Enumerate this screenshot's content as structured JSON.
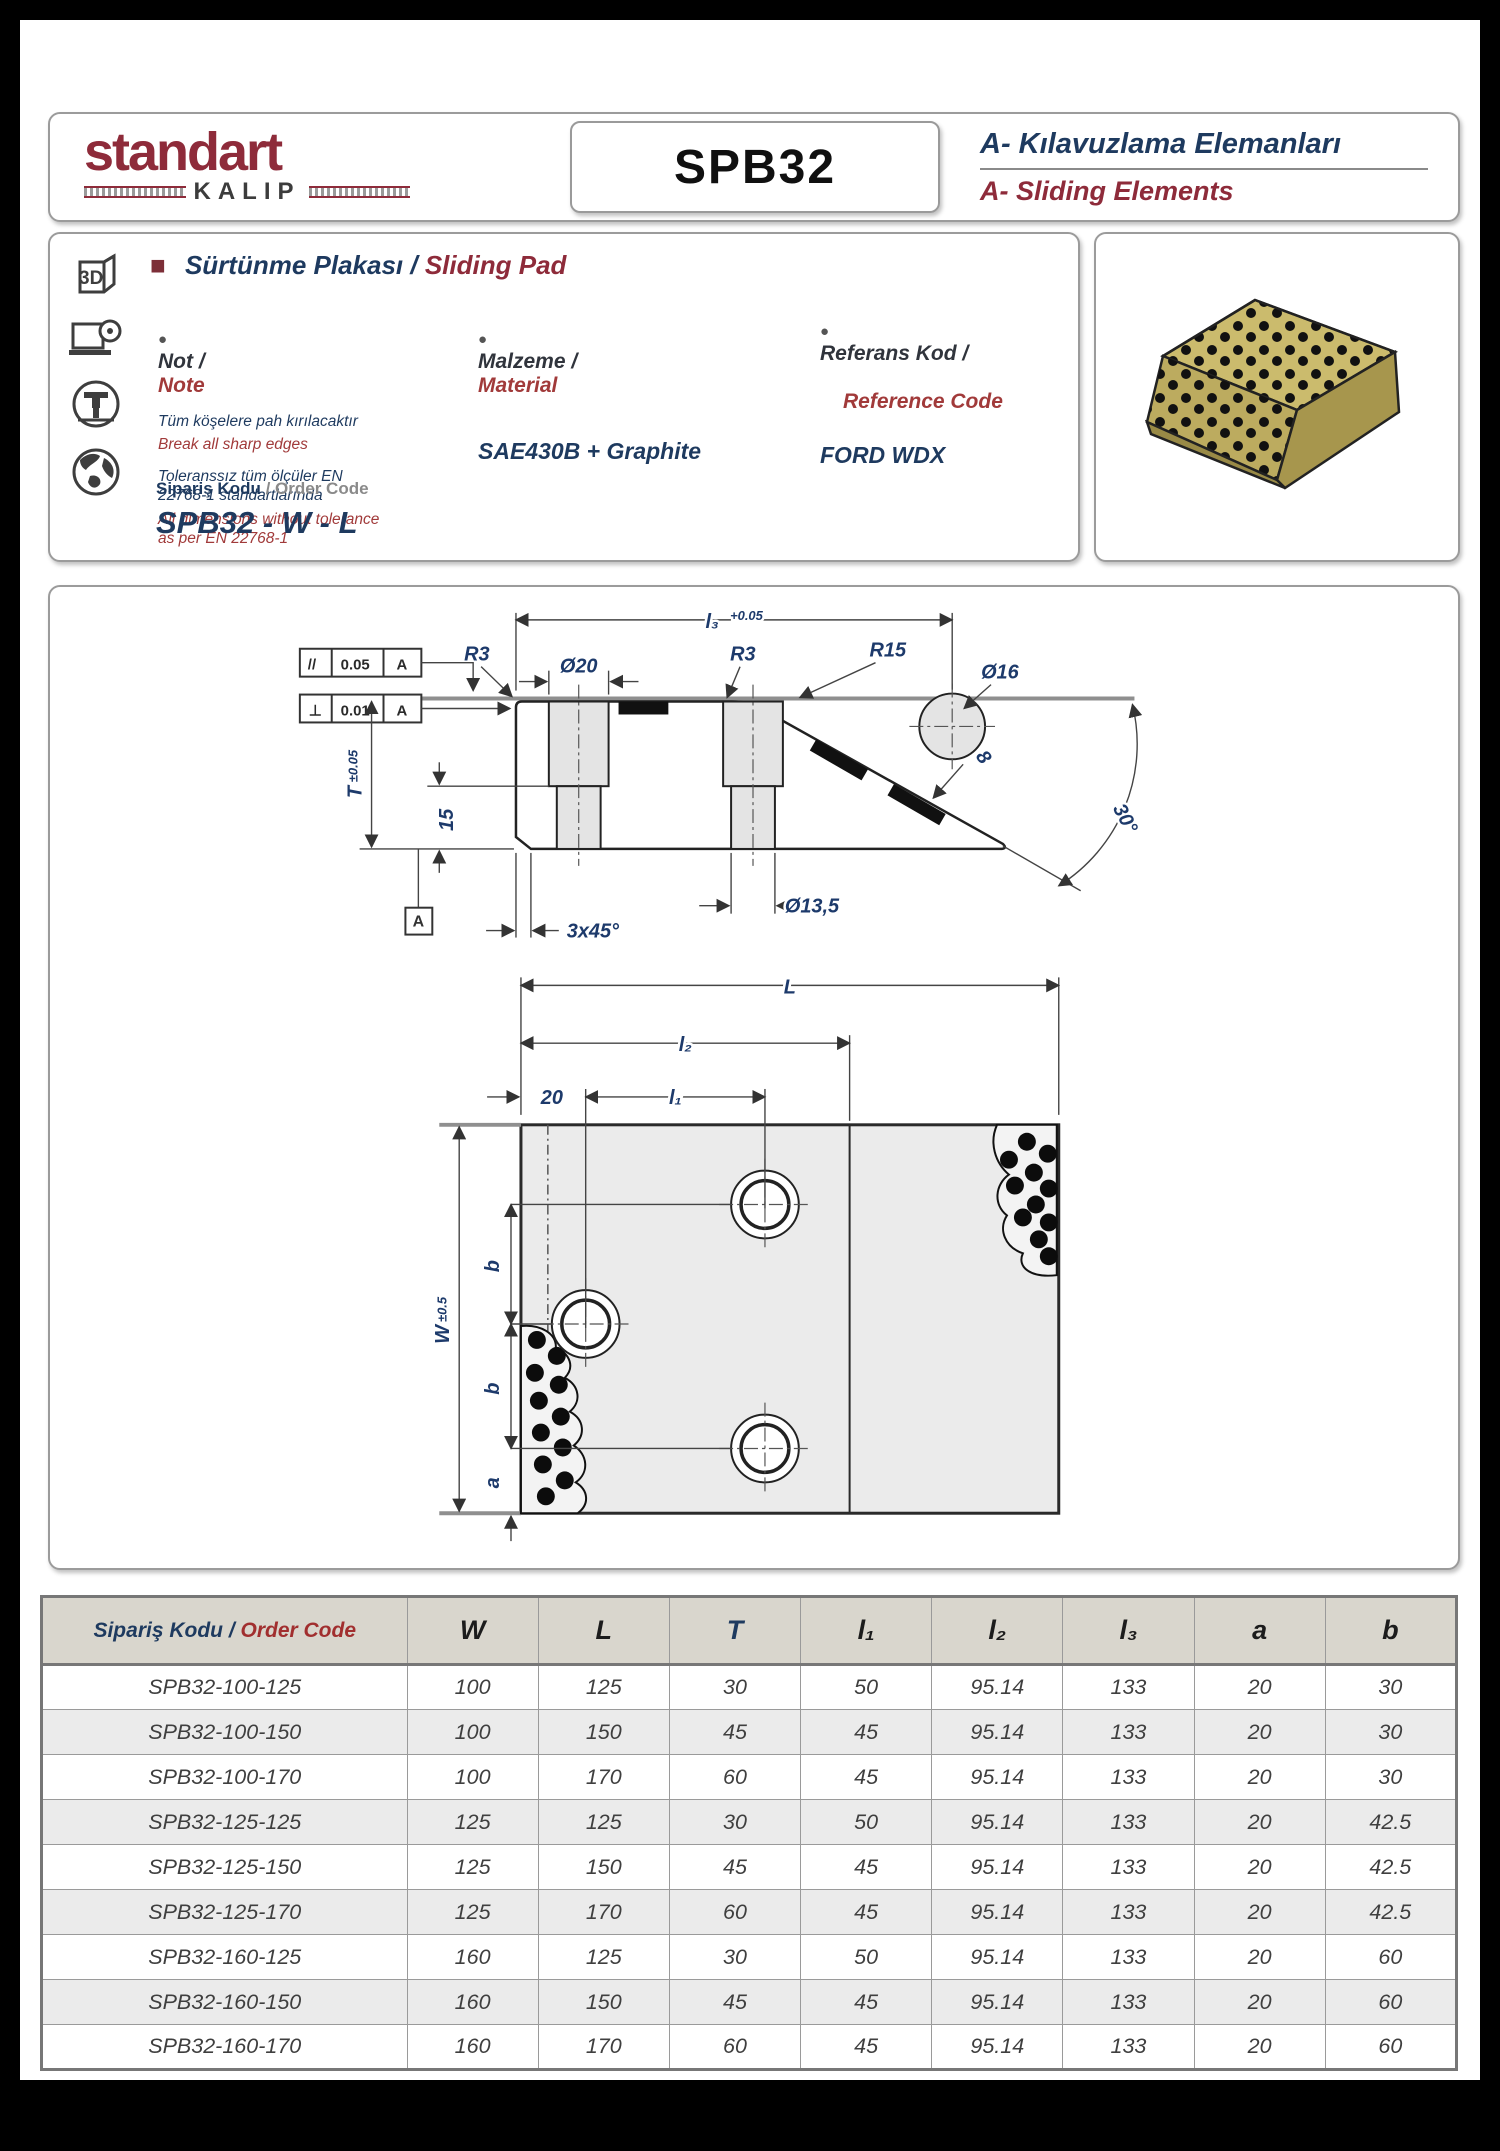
{
  "header": {
    "brand_name": "standart",
    "brand_sub": "KALIP",
    "part_code": "SPB32",
    "category_tr": "A- Kılavuzlama Elemanları",
    "category_en": "A- Sliding Elements"
  },
  "info": {
    "bullet": "●",
    "square": "■",
    "title_tr": "Sürtünme Plakası /",
    "title_en": "Sliding Pad",
    "note": {
      "label_tr": "Not /",
      "label_en": "Note",
      "line1_tr": "Tüm köşelere pah kırılacaktır",
      "line1_en": "Break all sharp edges",
      "line2_tr": "Toleranssız tüm ölçüler EN 22768-1 standartlarında",
      "line2_en": "All dimensions without tolerance as per EN 22768-1"
    },
    "material": {
      "label_tr": "Malzeme /",
      "label_en": "Material",
      "value": "SAE430B + Graphite"
    },
    "reference": {
      "label_tr": "Referans Kod /",
      "label_en": "Reference Code",
      "value": "FORD WDX"
    },
    "order_code": {
      "label_tr": "Sipariş Kodu",
      "label_sep": " / ",
      "label_en": "Order Code",
      "value": "SPB32 - W - L"
    },
    "icons": [
      "3d-cube-icon",
      "laptop-cd-icon",
      "cnc-mill-icon",
      "globe-icon"
    ]
  },
  "drawing": {
    "labels": {
      "l3": "l₃",
      "l3_tol": "+0.05",
      "r3_left": "R3",
      "d20": "Ø20",
      "r3_mid": "R3",
      "r15": "R15",
      "d16": "Ø16",
      "par_sym": "//",
      "par_val": "0.05",
      "par_datum": "A",
      "perp_sym": "⊥",
      "perp_val": "0.01",
      "perp_datum": "A",
      "t": "T",
      "t_tol": "±0.05",
      "v15": "15",
      "datum_a": "A",
      "chamfer": "3x45°",
      "d135": "Ø13,5",
      "angle30": "30°",
      "plug8": "8",
      "L": "L",
      "l2": "l₂",
      "l1": "l₁",
      "v20": "20",
      "w": "W",
      "w_tol": "±0.5",
      "b1": "b",
      "b2": "b",
      "a": "a"
    }
  },
  "table": {
    "code_header_tr": "Sipariş Kodu / ",
    "code_header_en": "Order Code",
    "columns": [
      "W",
      "L",
      "T",
      "l₁",
      "l₂",
      "l₃",
      "a",
      "b"
    ],
    "rows": [
      [
        "SPB32-100-125",
        "100",
        "125",
        "30",
        "50",
        "95.14",
        "133",
        "20",
        "30"
      ],
      [
        "SPB32-100-150",
        "100",
        "150",
        "45",
        "45",
        "95.14",
        "133",
        "20",
        "30"
      ],
      [
        "SPB32-100-170",
        "100",
        "170",
        "60",
        "45",
        "95.14",
        "133",
        "20",
        "30"
      ],
      [
        "SPB32-125-125",
        "125",
        "125",
        "30",
        "50",
        "95.14",
        "133",
        "20",
        "42.5"
      ],
      [
        "SPB32-125-150",
        "125",
        "150",
        "45",
        "45",
        "95.14",
        "133",
        "20",
        "42.5"
      ],
      [
        "SPB32-125-170",
        "125",
        "170",
        "60",
        "45",
        "95.14",
        "133",
        "20",
        "42.5"
      ],
      [
        "SPB32-160-125",
        "160",
        "125",
        "30",
        "50",
        "95.14",
        "133",
        "20",
        "60"
      ],
      [
        "SPB32-160-150",
        "160",
        "150",
        "45",
        "45",
        "95.14",
        "133",
        "20",
        "60"
      ],
      [
        "SPB32-160-170",
        "160",
        "170",
        "60",
        "45",
        "95.14",
        "133",
        "20",
        "60"
      ]
    ]
  },
  "colors": {
    "accent_maroon": "#8e2b3a",
    "navy": "#1e3a5f",
    "red_text": "#a13a3a",
    "gold_3d": "#c9b96a"
  }
}
